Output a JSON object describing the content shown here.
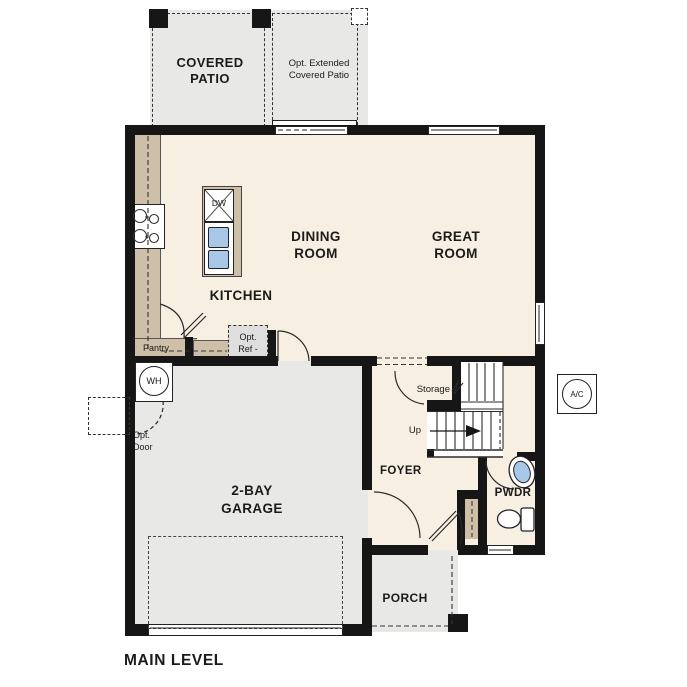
{
  "title": "MAIN LEVEL",
  "colors": {
    "wall": "#161616",
    "interior_floor": "#f7efe2",
    "exterior_floor": "#e8e8e6",
    "cabinet": "#cec0a8",
    "fixture_blue": "#a8c8e8",
    "ref_box": "#dedede"
  },
  "rooms": {
    "covered_patio": "COVERED\nPATIO",
    "dining_room": "DINING\nROOM",
    "great_room": "GREAT\nROOM",
    "kitchen": "KITCHEN",
    "garage": "2-BAY\nGARAGE",
    "foyer": "FOYER",
    "powder": "PWDR",
    "porch": "PORCH"
  },
  "labels": {
    "opt_extended_patio": "Opt. Extended\nCovered Patio",
    "pantry": "Pantry",
    "opt_ref": "Opt.\nRef -",
    "storage": "Storage",
    "up": "Up",
    "opt_door": "Opt.\nDoor"
  },
  "fixtures": {
    "water_heater": "WH",
    "ac_unit": "A/C",
    "dishwasher": "DW"
  }
}
